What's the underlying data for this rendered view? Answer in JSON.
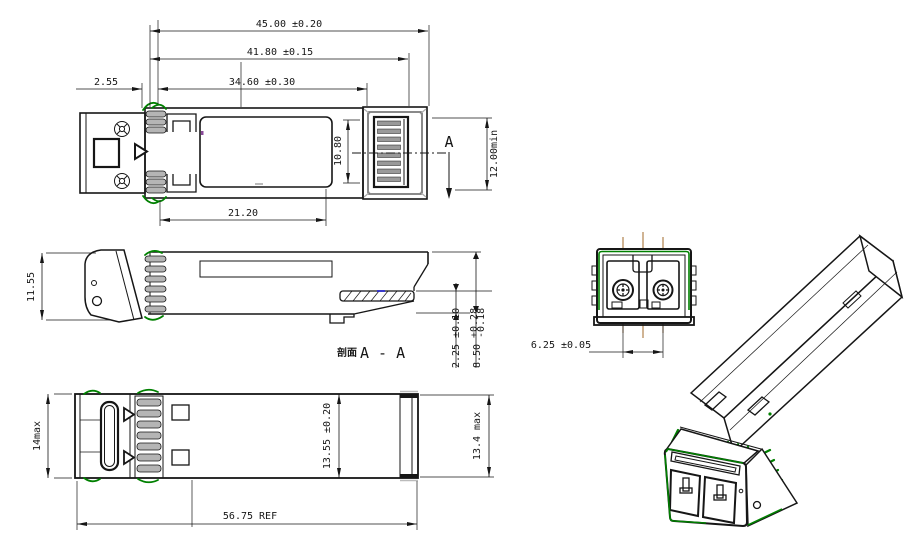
{
  "drawing_title": "SFP transceiver outline drawing",
  "colors": {
    "line": "#161616",
    "gasket_green": "#008000",
    "centerline_orange": "#a06a2a",
    "mark_blue": "#2a2acc",
    "mark_purple": "#8a4a9a"
  },
  "top_view": {
    "dim_overall": "45.00 ±0.20",
    "dim_to_pads": "41.80 ±0.15",
    "dim_body": "34.60 ±0.30",
    "dim_front": "2.55",
    "dim_label": "21.20",
    "dim_pad_width": "10.80",
    "dim_min_depth": "12.00min",
    "section_letter": "A"
  },
  "side_view": {
    "dim_height": "11.55",
    "section_prefix": "剖面",
    "section_title": "A - A",
    "dim_tongue": "2.25 ±0.10",
    "dim_h_base": "8.50",
    "dim_h_tol_plus": "+0.28",
    "dim_h_tol_minus": "-0.18"
  },
  "bottom_view": {
    "dim_front_height": "14max",
    "dim_body_width": "13.55 ±0.20",
    "dim_max_width": "13.4 max",
    "dim_length_ref": "56.75 REF"
  },
  "front_view": {
    "dim_ferrule_pitch": "6.25 ±0.05"
  }
}
